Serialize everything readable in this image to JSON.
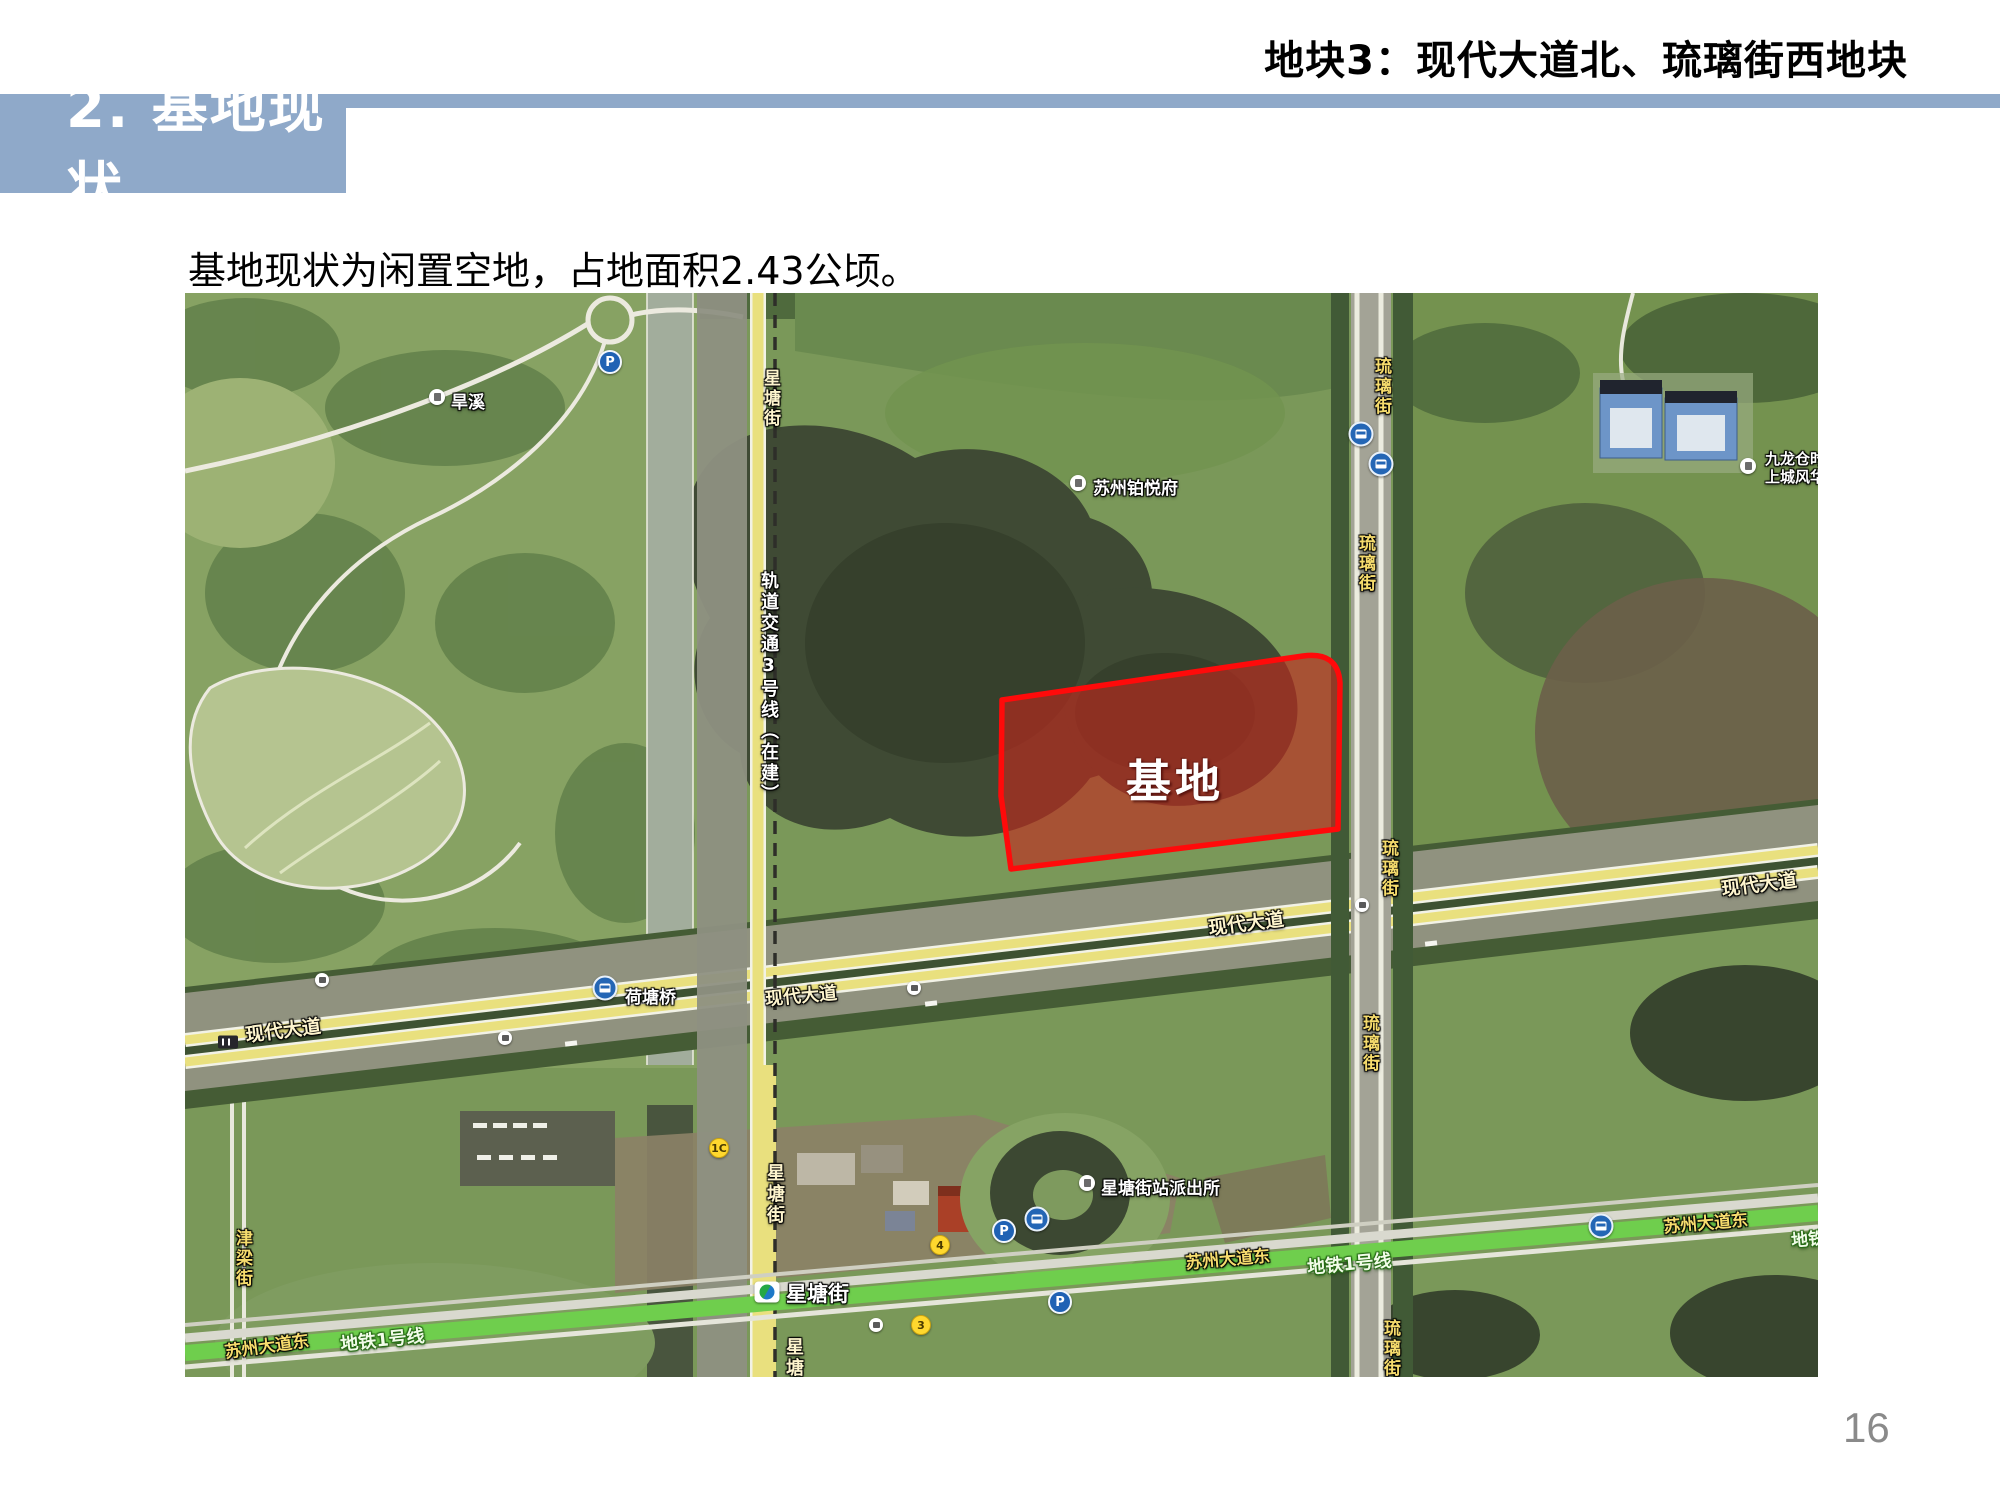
{
  "slide": {
    "header_title": "地块3：现代大道北、琉璃街西地块",
    "section_title": "2. 基地现状",
    "body_text": "基地现状为闲置空地，占地面积2.43公顷。",
    "page_number": "16"
  },
  "map": {
    "site_label": "基地",
    "roads": {
      "xingtangjie": "星塘街",
      "liulijie": "琉璃街",
      "xiandai_dadao": "现代大道",
      "suzhou_dadao_dong": "苏州大道东",
      "metro_line1": "地铁1号线",
      "jinliangjie": "津梁街",
      "rail_line3": "轨道交通3号线（在建）"
    },
    "pois": {
      "hanxi": "旱溪",
      "suzhou_boyuefu": "苏州铂悦府",
      "jiulongcang_line1": "九龙仓时",
      "jiulongcang_line2": "上城风华",
      "police_station": "星塘街站派出所",
      "hetang_bridge": "荷塘桥",
      "metro_station": "星塘街"
    },
    "markers": {
      "parking": "P",
      "exit_1c": "1C",
      "exit_4": "4",
      "exit_3": "3"
    },
    "colors": {
      "accent_bar": "#8fa9c9",
      "site_fill": "#c3261d",
      "site_border": "#ff0a0a",
      "road_yellow": "#e9e07e",
      "metro_green": "#6fce4d"
    }
  }
}
